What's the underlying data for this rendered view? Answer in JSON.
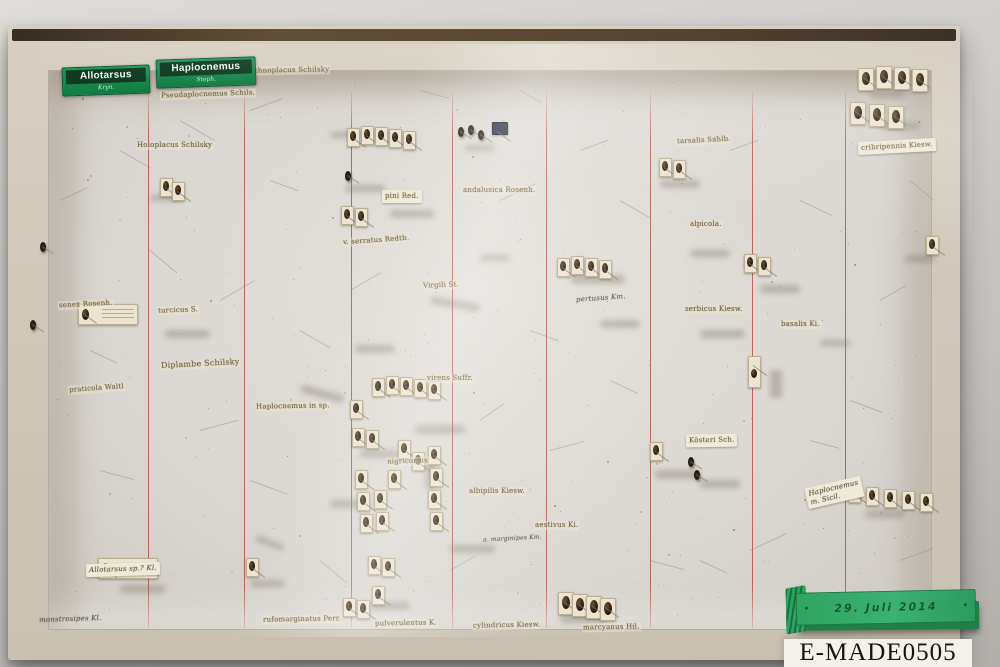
{
  "meta": {
    "catalog_number": "E-MADE0505",
    "date_label": "29. Juli 2014"
  },
  "genus_labels": [
    {
      "name": "Allotarsus",
      "sub": "Kryn.",
      "x": 62,
      "y": 66,
      "w": 80
    },
    {
      "name": "Haplocnemus",
      "sub": "Steph.",
      "x": 156,
      "y": 58,
      "w": 92
    }
  ],
  "species_labels": [
    {
      "t": "Ischnoplacus Schilsky",
      "x": 246,
      "y": 66,
      "r": -1
    },
    {
      "t": "Pseudaplocnemus Schils.",
      "x": 160,
      "y": 90,
      "r": -2
    },
    {
      "t": "Holoplacus Schilsky",
      "x": 136,
      "y": 141,
      "r": 0
    },
    {
      "t": "pini Red.",
      "x": 382,
      "y": 190,
      "r": 0,
      "v": "paper"
    },
    {
      "t": "andalusica Rosenh.",
      "x": 462,
      "y": 186,
      "r": 0
    },
    {
      "t": "v. serratus Redtb.",
      "x": 342,
      "y": 236,
      "r": -4
    },
    {
      "t": "Virgili St.",
      "x": 422,
      "y": 281,
      "r": -2
    },
    {
      "t": "senex Rosenh.",
      "x": 58,
      "y": 300,
      "r": -3
    },
    {
      "t": "turcicus S.",
      "x": 157,
      "y": 306,
      "r": -2
    },
    {
      "t": "Diplambe Schilsky",
      "x": 160,
      "y": 360,
      "r": -3,
      "v": "big"
    },
    {
      "t": "praticola Waltl",
      "x": 68,
      "y": 384,
      "r": -4
    },
    {
      "t": "Haplocnemus in sp.",
      "x": 255,
      "y": 402,
      "r": -1
    },
    {
      "t": "virens Suffr.",
      "x": 426,
      "y": 374,
      "r": 0
    },
    {
      "t": "nigricornis",
      "x": 386,
      "y": 457,
      "r": -2
    },
    {
      "t": "albipilis Kiesw.",
      "x": 468,
      "y": 487,
      "r": 0
    },
    {
      "t": "aestivus Ki.",
      "x": 534,
      "y": 521,
      "r": 0
    },
    {
      "t": "tarsalis Sahlb.",
      "x": 676,
      "y": 136,
      "r": -3
    },
    {
      "t": "alpicola.",
      "x": 689,
      "y": 220,
      "r": 0
    },
    {
      "t": "pertusus Km.",
      "x": 575,
      "y": 294,
      "r": -4,
      "v": "hand"
    },
    {
      "t": "serbicus Kiesw.",
      "x": 684,
      "y": 305,
      "r": 0
    },
    {
      "t": "basalis Ki.",
      "x": 780,
      "y": 320,
      "r": 0
    },
    {
      "t": "Kösteri Sch.",
      "x": 686,
      "y": 434,
      "r": -1,
      "v": "paper"
    },
    {
      "t": "cribripennis Kiesw.",
      "x": 858,
      "y": 140,
      "r": -3,
      "v": "paper"
    },
    {
      "t": "rufomarginatus Perr.",
      "x": 262,
      "y": 615,
      "r": -1
    },
    {
      "t": "pulverulentus K.",
      "x": 374,
      "y": 619,
      "r": -1
    },
    {
      "t": "cylindricus Kiesw.",
      "x": 472,
      "y": 621,
      "r": -1
    },
    {
      "t": "marcyanus Hil.",
      "x": 582,
      "y": 623,
      "r": -1
    },
    {
      "t": "Allotarsus sp.? Kl.",
      "x": 86,
      "y": 563,
      "r": -2,
      "v": "hand paper"
    },
    {
      "t": "monstrosipes Kl.",
      "x": 38,
      "y": 615,
      "r": -2,
      "v": "hand"
    },
    {
      "t": "a. marginipes Km.",
      "x": 482,
      "y": 535,
      "r": -3,
      "v": "hand small"
    },
    {
      "t": "Haplocnemus\nm. Sicil.",
      "x": 806,
      "y": 482,
      "r": -13,
      "v": "hand paper"
    }
  ],
  "red_lines": {
    "xs": [
      148,
      244,
      351,
      452,
      546,
      650,
      752,
      845
    ],
    "color": "#b03a31"
  },
  "specimen_cards": [
    {
      "x": 858,
      "y": 68,
      "k": "vb"
    },
    {
      "x": 876,
      "y": 66,
      "k": "vb"
    },
    {
      "x": 894,
      "y": 67,
      "k": "vb"
    },
    {
      "x": 912,
      "y": 69,
      "k": "vb"
    },
    {
      "x": 850,
      "y": 102,
      "k": "vb"
    },
    {
      "x": 869,
      "y": 104,
      "k": "vb"
    },
    {
      "x": 888,
      "y": 106,
      "k": "vb"
    },
    {
      "x": 848,
      "y": 484
    },
    {
      "x": 866,
      "y": 487
    },
    {
      "x": 884,
      "y": 489
    },
    {
      "x": 902,
      "y": 491
    },
    {
      "x": 920,
      "y": 493
    },
    {
      "x": 347,
      "y": 128
    },
    {
      "x": 361,
      "y": 126
    },
    {
      "x": 375,
      "y": 127
    },
    {
      "x": 389,
      "y": 129
    },
    {
      "x": 403,
      "y": 131
    },
    {
      "x": 341,
      "y": 206
    },
    {
      "x": 355,
      "y": 208
    },
    {
      "x": 557,
      "y": 258
    },
    {
      "x": 571,
      "y": 256
    },
    {
      "x": 585,
      "y": 258
    },
    {
      "x": 599,
      "y": 260
    },
    {
      "x": 659,
      "y": 158
    },
    {
      "x": 673,
      "y": 160
    },
    {
      "x": 744,
      "y": 254
    },
    {
      "x": 758,
      "y": 257
    },
    {
      "x": 748,
      "y": 356,
      "k": "tall"
    },
    {
      "x": 650,
      "y": 442
    },
    {
      "x": 372,
      "y": 378
    },
    {
      "x": 386,
      "y": 376
    },
    {
      "x": 400,
      "y": 377
    },
    {
      "x": 414,
      "y": 379
    },
    {
      "x": 428,
      "y": 381
    },
    {
      "x": 350,
      "y": 400
    },
    {
      "x": 352,
      "y": 428
    },
    {
      "x": 366,
      "y": 430
    },
    {
      "x": 398,
      "y": 440
    },
    {
      "x": 412,
      "y": 452
    },
    {
      "x": 355,
      "y": 470
    },
    {
      "x": 388,
      "y": 470
    },
    {
      "x": 357,
      "y": 492
    },
    {
      "x": 374,
      "y": 490
    },
    {
      "x": 428,
      "y": 446
    },
    {
      "x": 430,
      "y": 468
    },
    {
      "x": 360,
      "y": 514
    },
    {
      "x": 376,
      "y": 512
    },
    {
      "x": 428,
      "y": 490
    },
    {
      "x": 430,
      "y": 512
    },
    {
      "x": 368,
      "y": 556
    },
    {
      "x": 382,
      "y": 558
    },
    {
      "x": 372,
      "y": 586
    },
    {
      "x": 343,
      "y": 598
    },
    {
      "x": 357,
      "y": 600
    },
    {
      "x": 558,
      "y": 592,
      "k": "vb"
    },
    {
      "x": 572,
      "y": 594,
      "k": "vb"
    },
    {
      "x": 586,
      "y": 596,
      "k": "vb"
    },
    {
      "x": 600,
      "y": 598,
      "k": "vb"
    },
    {
      "x": 246,
      "y": 558
    },
    {
      "x": 160,
      "y": 178
    },
    {
      "x": 172,
      "y": 182
    },
    {
      "x": 926,
      "y": 236
    },
    {
      "x": 78,
      "y": 304,
      "k": "h"
    },
    {
      "x": 98,
      "y": 558,
      "k": "h"
    },
    {
      "x": 492,
      "y": 122,
      "k": "navy"
    }
  ],
  "bugs": [
    {
      "x": 40,
      "y": 242
    },
    {
      "x": 30,
      "y": 320
    },
    {
      "x": 345,
      "y": 171
    },
    {
      "x": 458,
      "y": 127
    },
    {
      "x": 468,
      "y": 125
    },
    {
      "x": 478,
      "y": 130
    },
    {
      "x": 688,
      "y": 457
    },
    {
      "x": 694,
      "y": 470
    }
  ],
  "smudges": [
    [
      150,
      195,
      30,
      6,
      0
    ],
    [
      95,
      315,
      40,
      7,
      0
    ],
    [
      165,
      330,
      45,
      8,
      0
    ],
    [
      345,
      185,
      40,
      7,
      0
    ],
    [
      390,
      210,
      45,
      8,
      0
    ],
    [
      430,
      300,
      50,
      8,
      10
    ],
    [
      480,
      255,
      30,
      6,
      0
    ],
    [
      355,
      345,
      40,
      8,
      0
    ],
    [
      300,
      390,
      45,
      8,
      15
    ],
    [
      360,
      450,
      40,
      8,
      0
    ],
    [
      415,
      425,
      50,
      9,
      0
    ],
    [
      330,
      500,
      40,
      8,
      0
    ],
    [
      425,
      460,
      10,
      30,
      0
    ],
    [
      450,
      545,
      45,
      8,
      0
    ],
    [
      570,
      275,
      55,
      9,
      0
    ],
    [
      600,
      320,
      40,
      8,
      0
    ],
    [
      660,
      180,
      40,
      8,
      0
    ],
    [
      690,
      250,
      40,
      7,
      0
    ],
    [
      700,
      330,
      45,
      8,
      0
    ],
    [
      760,
      285,
      40,
      8,
      0
    ],
    [
      770,
      370,
      12,
      28,
      0
    ],
    [
      655,
      470,
      45,
      9,
      0
    ],
    [
      700,
      480,
      40,
      8,
      0
    ],
    [
      870,
      90,
      35,
      8,
      0
    ],
    [
      880,
      122,
      40,
      8,
      0
    ],
    [
      250,
      580,
      35,
      7,
      0
    ],
    [
      120,
      585,
      45,
      8,
      0
    ],
    [
      370,
      602,
      40,
      8,
      0
    ],
    [
      560,
      615,
      45,
      8,
      0
    ],
    [
      865,
      510,
      40,
      8,
      0
    ],
    [
      905,
      255,
      30,
      7,
      0
    ],
    [
      330,
      132,
      30,
      6,
      0
    ],
    [
      465,
      145,
      30,
      6,
      0
    ],
    [
      255,
      540,
      30,
      6,
      20
    ],
    [
      820,
      340,
      30,
      6,
      0
    ]
  ],
  "pins": [
    [
      180,
      120,
      40,
      30
    ],
    [
      250,
      110,
      35,
      -20
    ],
    [
      420,
      90,
      30,
      15
    ],
    [
      150,
      250,
      35,
      40
    ],
    [
      220,
      300,
      40,
      -30
    ],
    [
      90,
      350,
      30,
      25
    ],
    [
      200,
      430,
      40,
      -15
    ],
    [
      300,
      330,
      35,
      30
    ],
    [
      500,
      200,
      40,
      -25
    ],
    [
      530,
      330,
      30,
      20
    ],
    [
      620,
      200,
      35,
      30
    ],
    [
      730,
      150,
      30,
      -20
    ],
    [
      800,
      200,
      35,
      25
    ],
    [
      880,
      300,
      30,
      -30
    ],
    [
      850,
      400,
      35,
      20
    ],
    [
      750,
      550,
      40,
      -25
    ],
    [
      650,
      560,
      35,
      15
    ],
    [
      450,
      570,
      30,
      -30
    ],
    [
      250,
      480,
      40,
      20
    ],
    [
      550,
      450,
      35,
      -15
    ],
    [
      700,
      560,
      30,
      25
    ],
    [
      900,
      560,
      35,
      -20
    ],
    [
      100,
      470,
      35,
      15
    ],
    [
      60,
      200,
      30,
      -25
    ],
    [
      320,
      560,
      35,
      40
    ],
    [
      480,
      420,
      30,
      -35
    ],
    [
      610,
      380,
      30,
      25
    ],
    [
      810,
      440,
      30,
      15
    ],
    [
      910,
      180,
      30,
      40
    ],
    [
      350,
      290,
      35,
      -30
    ],
    [
      270,
      180,
      30,
      20
    ],
    [
      520,
      90,
      25,
      30
    ],
    [
      580,
      150,
      30,
      -20
    ],
    [
      120,
      150,
      35,
      30
    ]
  ]
}
